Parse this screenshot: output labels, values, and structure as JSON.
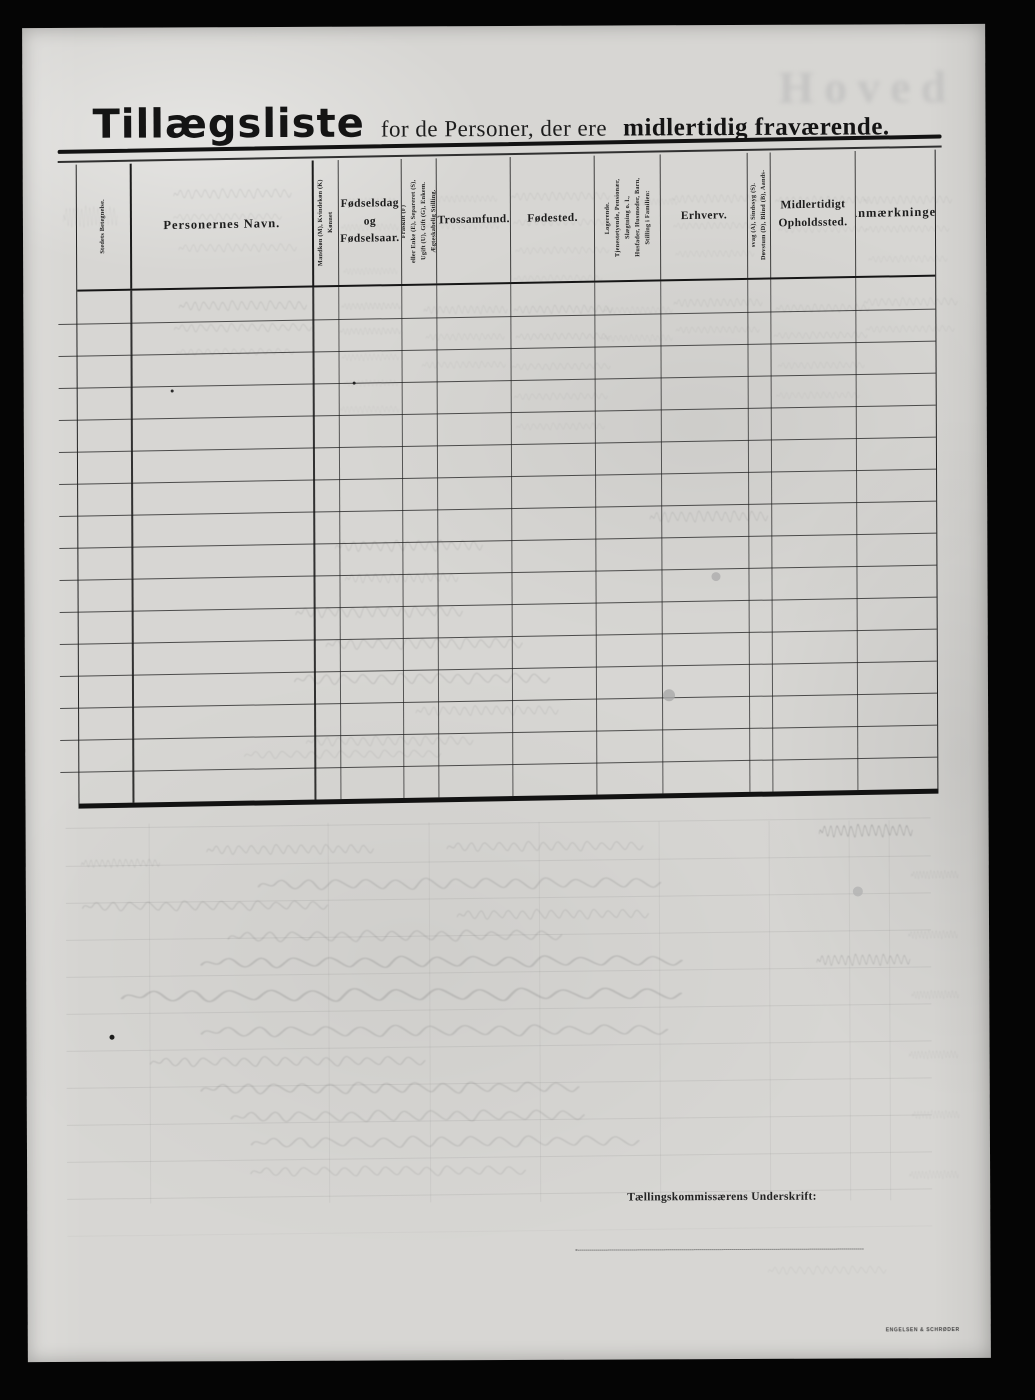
{
  "title": {
    "main": "Tillægsliste",
    "mid": "for de Personer, der ere",
    "bold": "midlertidig fraværende."
  },
  "ghost_text": "Hoved",
  "signature": {
    "label": "Tællingskommissærens Underskrift:"
  },
  "printer_mark": "ENGELSEN & SCHRØDER",
  "table": {
    "row_count": 16,
    "columns": [
      {
        "key": "stedets",
        "width_pct": 6.4,
        "orientation": "vertical",
        "label": "Stedets Betegnelse."
      },
      {
        "key": "navn",
        "width_pct": 21.2,
        "orientation": "horizontal",
        "label": "Personernes Navn."
      },
      {
        "key": "konnet",
        "width_pct": 2.9,
        "orientation": "vertical",
        "label": "Kønnet\nMandkøn (M), Kvindekøn (K)"
      },
      {
        "key": "fodselsdag",
        "width_pct": 7.4,
        "orientation": "horizontal",
        "label": "Fødselsdag\nog\nFødselsaar."
      },
      {
        "key": "aegteskabelig",
        "width_pct": 4.1,
        "orientation": "vertical",
        "label": "Ægteskabelig Stilling.\nUgift (U), Gift (G), Enkem.\neller Enke (E), Separeret (S),\nFraskilt (F)"
      },
      {
        "key": "trossamfund",
        "width_pct": 8.6,
        "orientation": "horizontal",
        "label": "Trossamfund."
      },
      {
        "key": "fodested",
        "width_pct": 9.8,
        "orientation": "horizontal",
        "label": "Fødested."
      },
      {
        "key": "stilling",
        "width_pct": 7.7,
        "orientation": "vertical",
        "label": "Stilling i Familien:\nHusfader, Husmoder, Barn,\nSlægtning o. l.,\nTjenestetyende, Pensionær,\nLogerende."
      },
      {
        "key": "erhverv",
        "width_pct": 10.1,
        "orientation": "horizontal",
        "label": "Erhverv."
      },
      {
        "key": "dovstum",
        "width_pct": 2.7,
        "orientation": "vertical",
        "label": "Døvstum (D), Blind (B), Aands-\nsvag (A), Sindssyg (S)."
      },
      {
        "key": "midlertidigt",
        "width_pct": 9.9,
        "orientation": "horizontal",
        "label": "Midlertidigt\nOpholdssted."
      },
      {
        "key": "anmaerkninger",
        "width_pct": 9.2,
        "orientation": "horizontal",
        "label": "Anmærkninger"
      }
    ]
  }
}
